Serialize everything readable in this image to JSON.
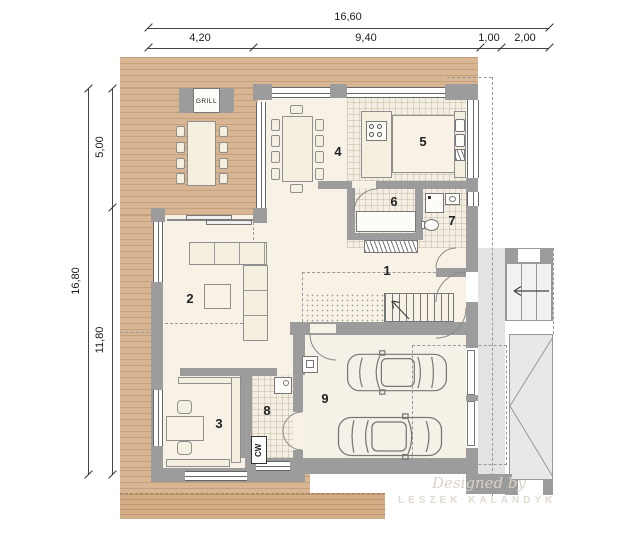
{
  "dims": {
    "top_total": "16,60",
    "top_seg": [
      "4,20",
      "9,40",
      "1,00",
      "2,00"
    ],
    "left_total": "16,80",
    "left_seg": [
      "5,00",
      "11,80"
    ]
  },
  "rooms": [
    "1",
    "2",
    "3",
    "4",
    "5",
    "6",
    "7",
    "8",
    "9"
  ],
  "labels": {
    "grill": "GRILL",
    "cw": "CW"
  },
  "watermark": {
    "line1": "Designed by",
    "line2": "LESZEK KALANDYK"
  },
  "colors": {
    "deck": "#d8b693",
    "wall": "#9c9c9c",
    "floor": "#f7f2e5",
    "tile": "#f4efe2",
    "paving": "#e3e3e1",
    "text": "#1a1a1a"
  }
}
